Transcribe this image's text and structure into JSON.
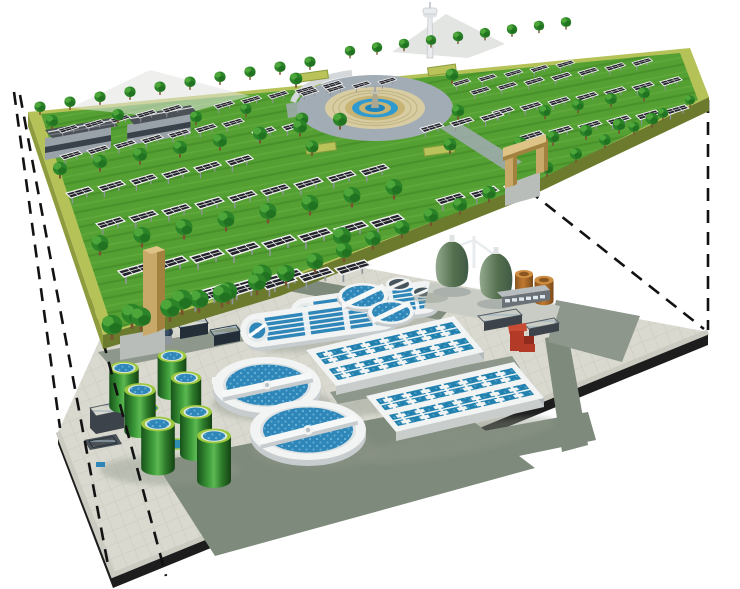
{
  "title": "Exploded 3D diagram: park with solar field above an underground wastewater treatment plant",
  "visible_text": [],
  "colors": {
    "bg": "#ffffff",
    "dash": "#121212",
    "grass": "#55a033",
    "band": "#b5c257",
    "sideL": "#8e9c3e",
    "sideF": "#6b7a2c",
    "tan": "#c9a96a",
    "tanD": "#a3823f",
    "tanL": "#ddc486",
    "rim": "#f2f4f4",
    "rimS": "#c7cdcf",
    "water": "#2f86b8",
    "lane": "#2180ad",
    "road": "#7e8a7b",
    "road2": "#8d978c",
    "slabSide": "#1d1d1d",
    "curb": "#cbcbc2",
    "roofD": "#4b5157",
    "wall": "#9aa2a9",
    "win": "#39414a",
    "tower": "#e9ebed",
    "pale": "#e2e4e0",
    "ring": "#a2acb4",
    "ppave": "#d8cda2",
    "ftan": "#c8b575",
    "fblue": "#2f9ad0",
    "fblue2": "#1f86bc",
    "brownTop": "#cf8f42",
    "red1": "#b23a27",
    "red2": "#8f2c1d",
    "red3": "#c84b33",
    "dark1": "#3d434a",
    "dark2": "#60686f",
    "shadow": "#8e958b",
    "treeBase": "#2b8428",
    "treeLight": "#52ab3c",
    "treeDark": "#1c671c",
    "trunk": "#7a5230",
    "panel": "#23242b",
    "panelFrame": "#f3f3f3",
    "post": "#8f969b",
    "tankRim": "#9cc83e",
    "tankInner": "#dfeadf"
  },
  "scene": {
    "upper_level": {
      "name": "park-deck",
      "components": [
        "solar-panel-rows",
        "tree-rows",
        "central-fountain-plaza",
        "observation-tower",
        "service-buildings",
        "entrance-gates",
        "perimeter-band"
      ]
    },
    "lower_level": {
      "name": "treatment-plant-slab",
      "components": [
        "oxidation-ditches",
        "circular-clarifiers",
        "aeration-basins",
        "green-sludge-tanks",
        "egg-digesters",
        "storage-tanks",
        "plant-buildings",
        "pump-station"
      ]
    },
    "dashed_lines": [
      [
        20,
        95,
        108,
        565
      ],
      [
        46,
        128,
        166,
        576
      ],
      [
        14,
        92,
        60,
        428
      ],
      [
        708,
        100,
        708,
        330
      ],
      [
        528,
        190,
        704,
        329
      ]
    ],
    "solar_rows": [
      [
        118,
        262,
        36,
        -7,
        8,
        1.0
      ],
      [
        150,
        296,
        37,
        -7.4,
        6,
        1.05
      ],
      [
        190,
        284,
        38,
        -8,
        3,
        1.1
      ],
      [
        96,
        216,
        33,
        -6.6,
        9,
        0.85
      ],
      [
        66,
        186,
        32,
        -6.4,
        6,
        0.8
      ],
      [
        436,
        192,
        34,
        -6.6,
        3,
        0.85
      ],
      [
        60,
        150,
        27,
        -5.4,
        7,
        0.65
      ],
      [
        58,
        124,
        26,
        -5,
        5,
        0.6
      ],
      [
        214,
        100,
        27,
        -5,
        5,
        0.6
      ],
      [
        300,
        88,
        26,
        -3.8,
        4,
        0.55
      ],
      [
        452,
        78,
        26,
        -4.6,
        5,
        0.55
      ],
      [
        470,
        86,
        27,
        -4.8,
        7,
        0.6
      ],
      [
        492,
        106,
        28,
        -5,
        7,
        0.65
      ],
      [
        520,
        130,
        29,
        -5.2,
        6,
        0.7
      ],
      [
        420,
        122,
        30,
        -5.6,
        3,
        0.7
      ],
      [
        252,
        126,
        30,
        -5.6,
        2,
        0.7
      ]
    ],
    "tree_rows": [
      [
        40,
        108,
        30,
        -5,
        10,
        0.62
      ],
      [
        350,
        52,
        27,
        -3.6,
        9,
        0.58
      ],
      [
        60,
        170,
        40,
        -7,
        8,
        0.78
      ],
      [
        100,
        245,
        42,
        -8,
        8,
        0.95
      ],
      [
        520,
        144,
        33,
        -6,
        5,
        0.7
      ],
      [
        545,
        112,
        33,
        -6,
        4,
        0.65
      ]
    ],
    "trees_extra": [
      [
        112,
        327,
        1.15
      ],
      [
        141,
        319,
        1.12
      ],
      [
        170,
        310,
        1.09
      ],
      [
        199,
        301,
        1.06
      ],
      [
        228,
        293,
        1.03
      ],
      [
        257,
        284,
        1.0
      ],
      [
        286,
        275,
        0.97
      ],
      [
        315,
        263,
        0.94
      ],
      [
        344,
        252,
        0.91
      ],
      [
        373,
        240,
        0.88
      ],
      [
        402,
        229,
        0.85
      ],
      [
        431,
        217,
        0.82
      ],
      [
        460,
        206,
        0.79
      ],
      [
        489,
        194,
        0.76
      ],
      [
        547,
        169,
        0.7
      ],
      [
        576,
        155,
        0.67
      ],
      [
        605,
        141,
        0.64
      ],
      [
        634,
        128,
        0.61
      ],
      [
        663,
        114,
        0.58
      ],
      [
        690,
        101,
        0.55
      ],
      [
        296,
        80,
        0.7
      ],
      [
        302,
        120,
        0.7
      ],
      [
        312,
        148,
        0.72
      ],
      [
        452,
        76,
        0.7
      ],
      [
        458,
        112,
        0.7
      ],
      [
        450,
        146,
        0.72
      ],
      [
        52,
        122,
        0.68
      ],
      [
        118,
        116,
        0.66
      ],
      [
        196,
        118,
        0.66
      ],
      [
        246,
        110,
        0.62
      ],
      [
        182,
        302,
        1.18
      ],
      [
        262,
        276,
        1.1
      ],
      [
        342,
        238,
        1.02
      ],
      [
        132,
        316,
        1.15
      ],
      [
        222,
        296,
        1.05
      ]
    ],
    "green_tanks": [
      [
        172,
        356,
        0.9
      ],
      [
        124,
        368,
        0.92
      ],
      [
        186,
        378,
        0.95
      ],
      [
        140,
        390,
        0.98
      ],
      [
        196,
        412,
        1.0
      ],
      [
        158,
        424,
        1.05
      ],
      [
        214,
        436,
        1.06
      ]
    ],
    "basins": {
      "matrix": [
        0.9867,
        -0.2267,
        0.652,
        0.783
      ],
      "origins": [
        [
          306,
          350
        ],
        [
          366,
          396
        ]
      ],
      "tabs": {
        "x0": 16,
        "dx": 19,
        "cols": 7,
        "rows": [
          9.5,
          17,
          29.5,
          37
        ]
      }
    }
  }
}
